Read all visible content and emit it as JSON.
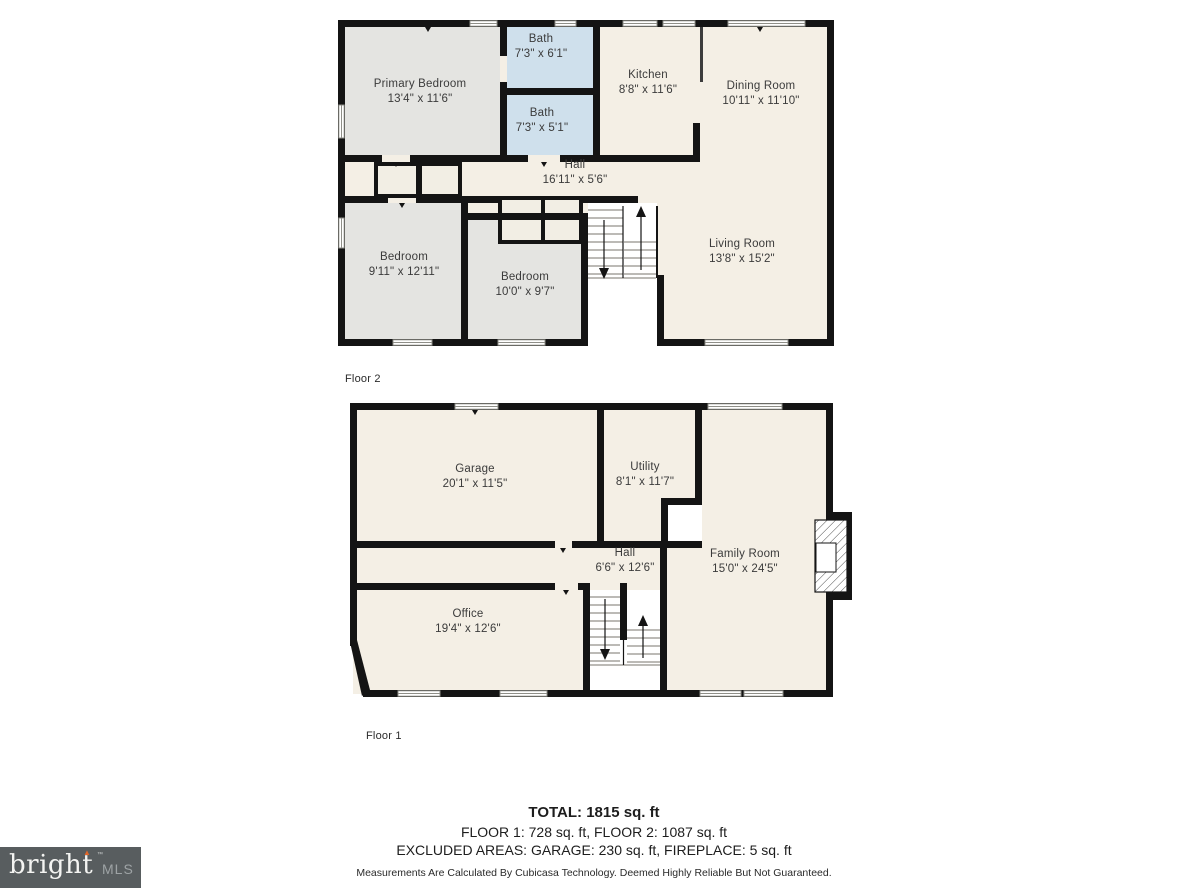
{
  "floor2": {
    "label": "Floor 2",
    "rooms": {
      "primary_bedroom": {
        "name": "Primary Bedroom",
        "dims": "13'4\" x 11'6\""
      },
      "bath_top": {
        "name": "Bath",
        "dims": "7'3\" x 6'1\""
      },
      "bath_bottom": {
        "name": "Bath",
        "dims": "7'3\" x 5'1\""
      },
      "kitchen": {
        "name": "Kitchen",
        "dims": "8'8\" x 11'6\""
      },
      "dining_room": {
        "name": "Dining Room",
        "dims": "10'11\" x 11'10\""
      },
      "hall": {
        "name": "Hall",
        "dims": "16'11\" x 5'6\""
      },
      "bedroom_left": {
        "name": "Bedroom",
        "dims": "9'11\" x 12'11\""
      },
      "bedroom_right": {
        "name": "Bedroom",
        "dims": "10'0\" x 9'7\""
      },
      "living_room": {
        "name": "Living Room",
        "dims": "13'8\" x 15'2\""
      }
    }
  },
  "floor1": {
    "label": "Floor 1",
    "rooms": {
      "garage": {
        "name": "Garage",
        "dims": "20'1\" x 11'5\""
      },
      "utility": {
        "name": "Utility",
        "dims": "8'1\" x 11'7\""
      },
      "hall": {
        "name": "Hall",
        "dims": "6'6\" x 12'6\""
      },
      "family_room": {
        "name": "Family Room",
        "dims": "15'0\" x 24'5\""
      },
      "office": {
        "name": "Office",
        "dims": "19'4\" x 12'6\""
      }
    }
  },
  "summary": {
    "total": "TOTAL: 1815 sq. ft",
    "floors": "FLOOR 1: 728 sq. ft, FLOOR 2: 1087 sq. ft",
    "excluded": "EXCLUDED AREAS: GARAGE: 230 sq. ft, FIREPLACE: 5 sq. ft",
    "disclaimer": "Measurements Are Calculated By Cubicasa Technology. Deemed Highly Reliable But Not Guaranteed."
  },
  "logo": {
    "brand": "bright",
    "suffix": "MLS",
    "tm": "™",
    "accent_icon": "▲"
  },
  "colors": {
    "floor_fill": "#f4efe5",
    "bedroom_fill": "#e4e4e1",
    "bath_fill": "#cfe0ec",
    "wall": "#141414",
    "logo_background": "#585d5f",
    "logo_accent": "#e0662a"
  }
}
